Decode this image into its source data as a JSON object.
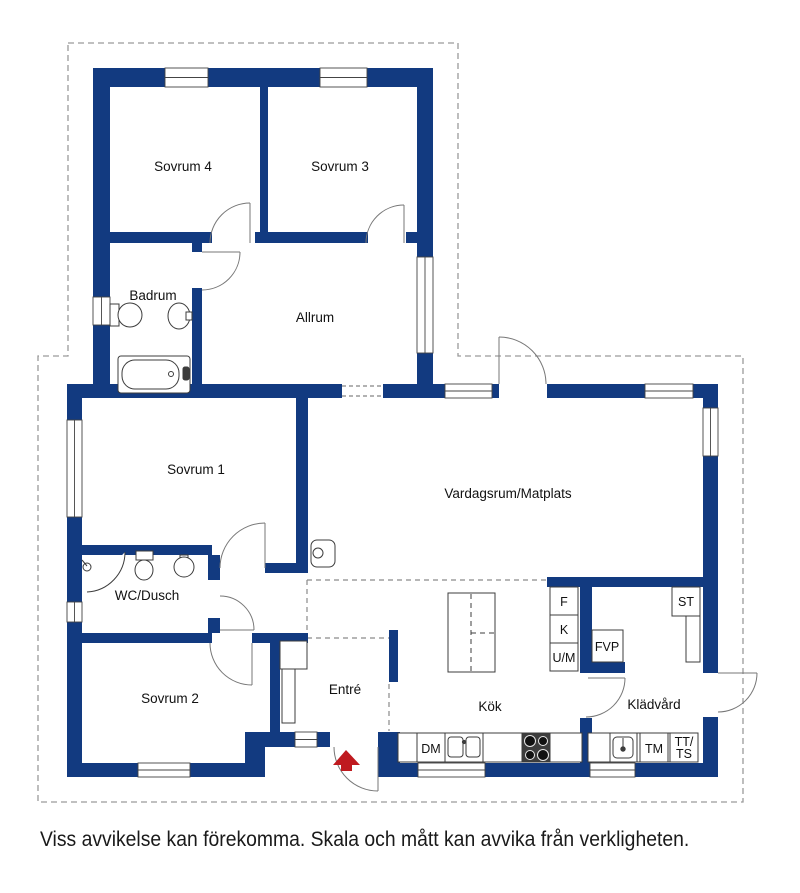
{
  "plan": {
    "wall_color": "#123a80",
    "boundary_color": "#9a9a9a",
    "fixture_color": "#3c3c3c",
    "door_color": "#777777",
    "arrow_color": "#bf1a1f",
    "rooms": {
      "sovrum4": "Sovrum 4",
      "sovrum3": "Sovrum 3",
      "badrum": "Badrum",
      "allrum": "Allrum",
      "sovrum1": "Sovrum 1",
      "vardagsrum": "Vardagsrum/Matplats",
      "wcdusch": "WC/Dusch",
      "sovrum2": "Sovrum 2",
      "entre": "Entré",
      "kok": "Kök",
      "kladvard": "Klädvård"
    },
    "appliances": {
      "fridge": "F",
      "freezer": "K",
      "oven_micro": "U/M",
      "heat_pump": "FVP",
      "closet": "ST",
      "dishwasher": "DM",
      "washing_machine": "TM",
      "dryer_line1": "TT/",
      "dryer_line2": "TS"
    }
  },
  "footer": {
    "disclaimer": "Viss avvikelse kan förekomma. Skala och mått kan avvika från verkligheten."
  }
}
